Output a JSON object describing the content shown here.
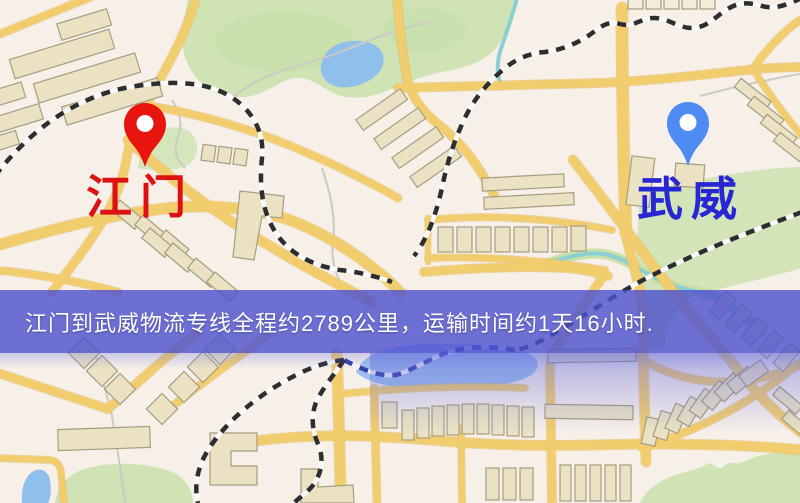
{
  "origin": {
    "name": "江门",
    "label_color": "#dd1111",
    "pin_color": "#e8150f"
  },
  "destination": {
    "name": "武威",
    "label_color": "#2626d4",
    "pin_color": "#4e8bf2"
  },
  "banner": {
    "text": "江门到武威物流专线全程约2789公里，运输时间约1天16小时.",
    "background": "#4e52ce",
    "text_color": "#ffffff"
  },
  "route": {
    "distance": "2789公里",
    "duration": "1天16小时"
  },
  "map_palette": {
    "background": "#f7f0e9",
    "road": "#f2cd6e",
    "road_casing": "#e3b95c",
    "building": "#eae2c3",
    "park": "#cfe3b5",
    "water": "#8fc0ec",
    "railway": "#2d2d2d"
  }
}
